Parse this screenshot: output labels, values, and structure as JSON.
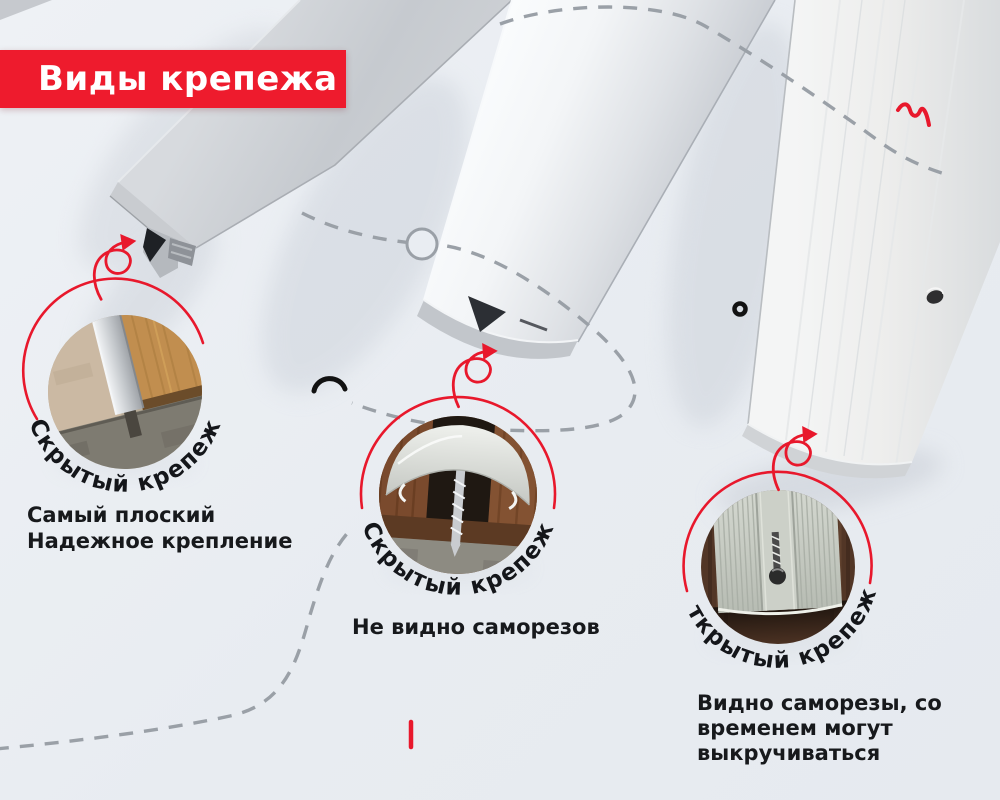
{
  "title": {
    "label": "Виды крепежа"
  },
  "fasteners": [
    {
      "arc_label": "Скрытый крепеж",
      "desc_lines": [
        "Самый плоский",
        "Надежное крепление"
      ]
    },
    {
      "arc_label": "Скрытый крепеж",
      "desc_lines": [
        "Не видно саморезов"
      ]
    },
    {
      "arc_label": "Открытый крепеж",
      "desc_lines": [
        "Видно саморезы, со",
        "временем могут",
        "выкручиваться"
      ]
    }
  ],
  "colors": {
    "banner_red": "#ee1b2d",
    "accent_red": "#e8182c",
    "background": "#e9edf2",
    "text_dark": "#17191c",
    "dash_gray": "#9aa0a7",
    "profile_silver": "#d4d7db"
  },
  "decorations": {
    "curl_arrow": "curl-arrow-icon",
    "squiggle": "squiggle-icon",
    "ring_marker": "ring-icon",
    "small_arc": "arc-icon",
    "tick": "tick-icon",
    "dashed_guides": "dashed-guide-lines"
  }
}
